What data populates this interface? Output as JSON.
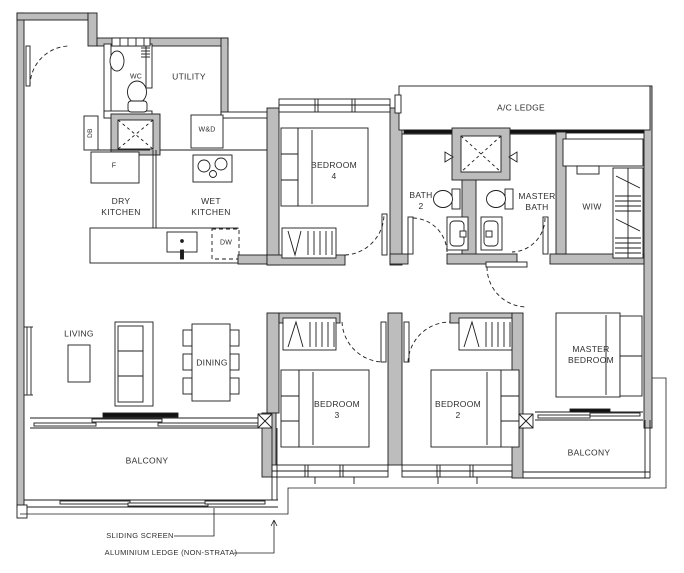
{
  "plan_type": "apartment-floor-plan",
  "colors": {
    "background": "#ffffff",
    "wall_fill": "#bdbdbd",
    "line": "#1c1c1c",
    "text": "#2e2e2e"
  },
  "rooms": {
    "wc": "WC",
    "utility": "UTILITY",
    "dry_kitchen": "DRY\nKITCHEN",
    "wet_kitchen": "WET\nKITCHEN",
    "bedroom4": "BEDROOM\n4",
    "ac_ledge": "A/C LEDGE",
    "bath2": "BATH\n2",
    "master_bath": "MASTER\nBATH",
    "wiw": "WIW",
    "living": "LIVING",
    "dining": "DINING",
    "bedroom3": "BEDROOM\n3",
    "bedroom2": "BEDROOM\n2",
    "master_bedroom": "MASTER\nBEDROOM",
    "balcony_left": "BALCONY",
    "balcony_right": "BALCONY"
  },
  "fixtures": {
    "db": "DB",
    "washer_dryer": "W&D",
    "fridge": "F",
    "dishwasher": "DW"
  },
  "annotations": {
    "sliding_screen": "SLIDING SCREEN",
    "aluminium_ledge": "ALUMINIUM LEDGE (NON-STRATA)"
  }
}
